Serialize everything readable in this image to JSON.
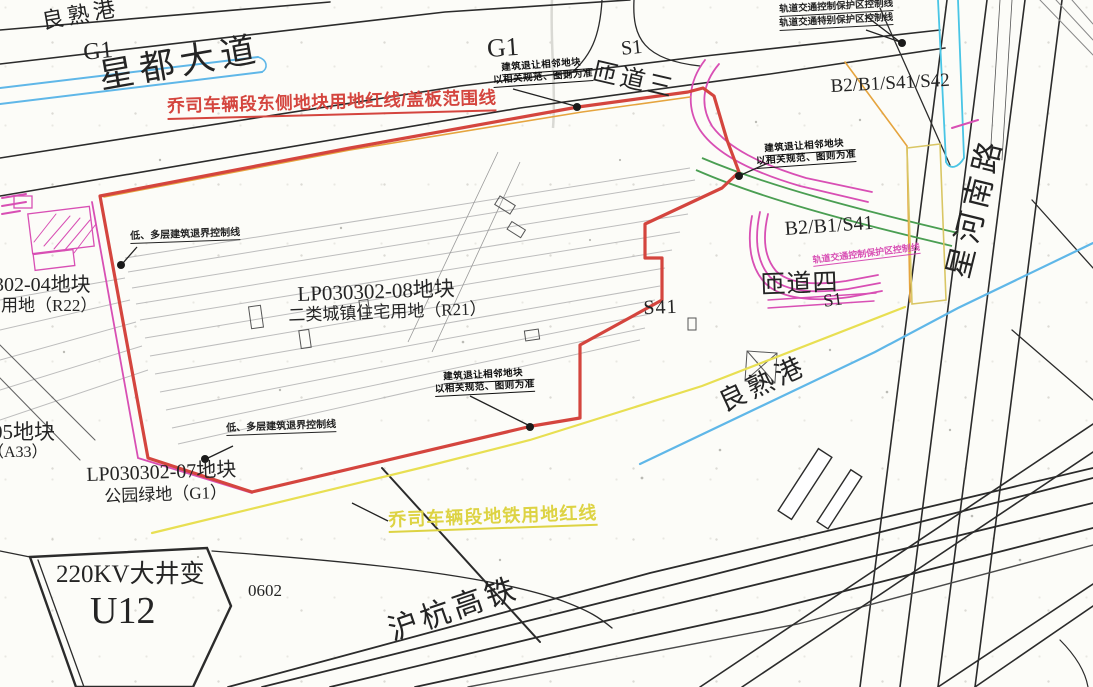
{
  "labels": {
    "canal": "良熟港",
    "g1": "G1",
    "xingdu_avenue": "星都大道",
    "red_title": "乔司车辆段东侧地块用地红线/盖板范围线",
    "s1": "S1",
    "ramp3": "匝道三",
    "ramp4": "匝道四",
    "setback_line1": "建筑退让相邻地块",
    "setback_line2": "以相关规范、图则为准",
    "rail_protect": "轨道交通控制保护区控制线",
    "rail_special": "轨道交通特别保护区控制线",
    "b2b1s41s42": "B2/B1/S41/S42",
    "b2b1s41": "B2/B1/S41",
    "s41": "S41",
    "xinghe_road": "星河南路",
    "lowrise_setback": "低、多层建筑退界控制线",
    "lp08_title": "LP030302-08地块",
    "lp08_use": "二类城镇住宅用地（R21）",
    "p04_title": "0302-04地块",
    "p04_use": "园用地（R22）",
    "p05_title": "05地块",
    "p05_use": "（A33）",
    "lp07_title": "LP030302-07地块",
    "lp07_use": "公园绿地（G1）",
    "yellow_title": "乔司车辆段地铁用地红线",
    "substation_name": "220KV大井变",
    "substation_code": "U12",
    "parcel_0602": "0602",
    "huhang_rail": "沪杭高铁"
  },
  "colors": {
    "boundary_red": "#d4453e",
    "metro_pink": "#d84fb4",
    "water_blue": "#5fb7e8",
    "cyan": "#49c5e5",
    "ramp_green": "#4a9e52",
    "orange": "#e5a43e",
    "khaki": "#d9c664",
    "metro_yellow_line": "#e8df52",
    "yellow_text": "#ddd343",
    "line_black": "#2b2b2b",
    "track_gray": "#bdbdbd"
  }
}
